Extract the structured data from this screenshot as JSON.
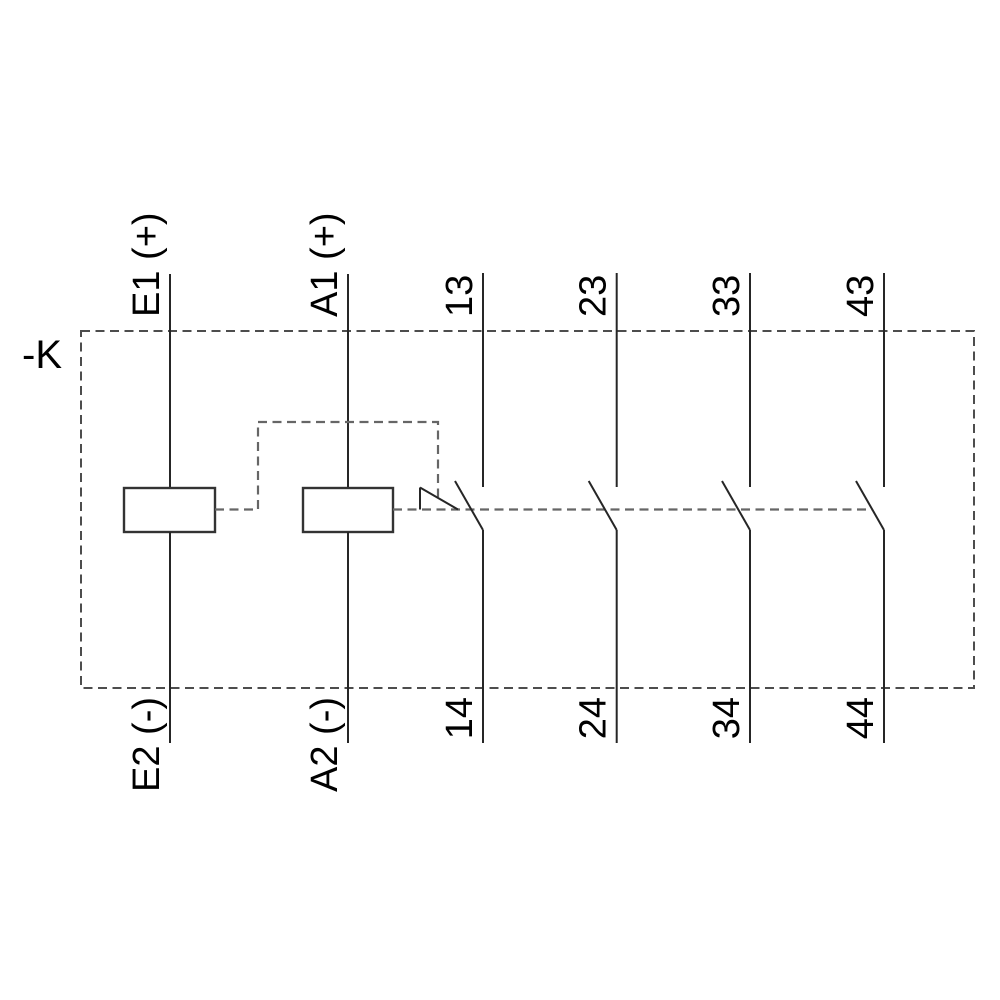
{
  "diagram": {
    "type": "relay-contactor-connection-schematic",
    "device": {
      "label": "-K"
    },
    "coils": [
      {
        "name": "e-coil",
        "top_label": "E1 (+)",
        "bottom_label": "E2 (-)"
      },
      {
        "name": "a-coil",
        "top_label": "A1 (+)",
        "bottom_label": "A2 (-)"
      }
    ],
    "contacts": [
      {
        "name": "no-contact-1",
        "top_label": "13",
        "bottom_label": "14"
      },
      {
        "name": "no-contact-2",
        "top_label": "23",
        "bottom_label": "24"
      },
      {
        "name": "no-contact-3",
        "top_label": "33",
        "bottom_label": "34"
      },
      {
        "name": "no-contact-4",
        "top_label": "43",
        "bottom_label": "44"
      }
    ],
    "colors": {
      "background": "#ffffff",
      "solid_line": "#262626",
      "dashed_boundary": "#4d4d4d",
      "dashed_linkage": "#666666",
      "text": "#000000"
    }
  }
}
